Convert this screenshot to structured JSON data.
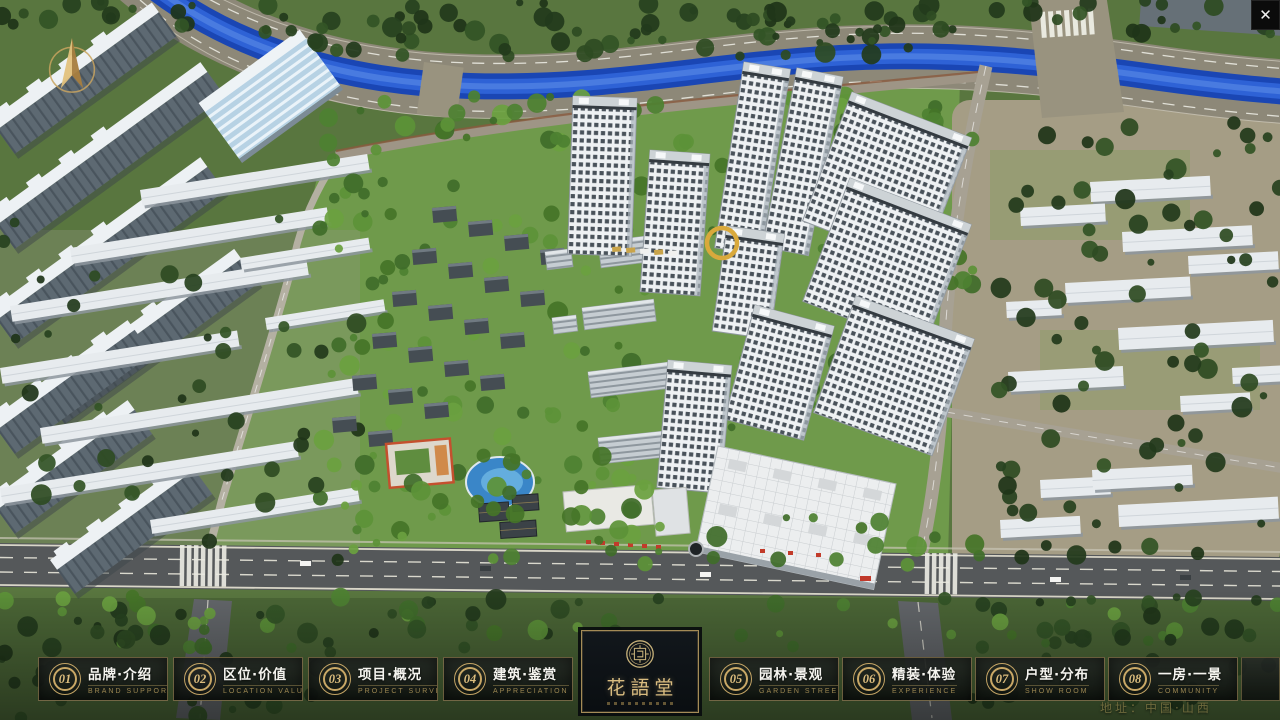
{
  "window": {
    "close_icon": "✕"
  },
  "map": {
    "address_label": "地址：中国·山西"
  },
  "nav": {
    "items": [
      {
        "num": "01",
        "title": "品牌·介绍",
        "subtitle": "BRAND SUPPORT"
      },
      {
        "num": "02",
        "title": "区位·价值",
        "subtitle": "LOCATION VALUE"
      },
      {
        "num": "03",
        "title": "项目·概况",
        "subtitle": "PROJECT SURVEY"
      },
      {
        "num": "04",
        "title": "建筑·鉴赏",
        "subtitle": "APPRECIATION"
      },
      {
        "num": "05",
        "title": "园林·景观",
        "subtitle": "GARDEN STREET"
      },
      {
        "num": "06",
        "title": "精装·体验",
        "subtitle": "EXPERIENCE"
      },
      {
        "num": "07",
        "title": "户型·分布",
        "subtitle": "SHOW ROOM"
      },
      {
        "num": "08",
        "title": "一房·一景",
        "subtitle": "COMMUNITY"
      }
    ],
    "logo": {
      "title": "花語堂"
    }
  },
  "colors": {
    "accent_gold": "#c9a866",
    "nav_text": "#f5f4ef",
    "subtitle_gold": "#9c8752",
    "river_blue": "#1a46b4",
    "lawn_green": "#6f9a4b",
    "road_grey": "#55585a",
    "address_gold": "#6e6a3c"
  }
}
